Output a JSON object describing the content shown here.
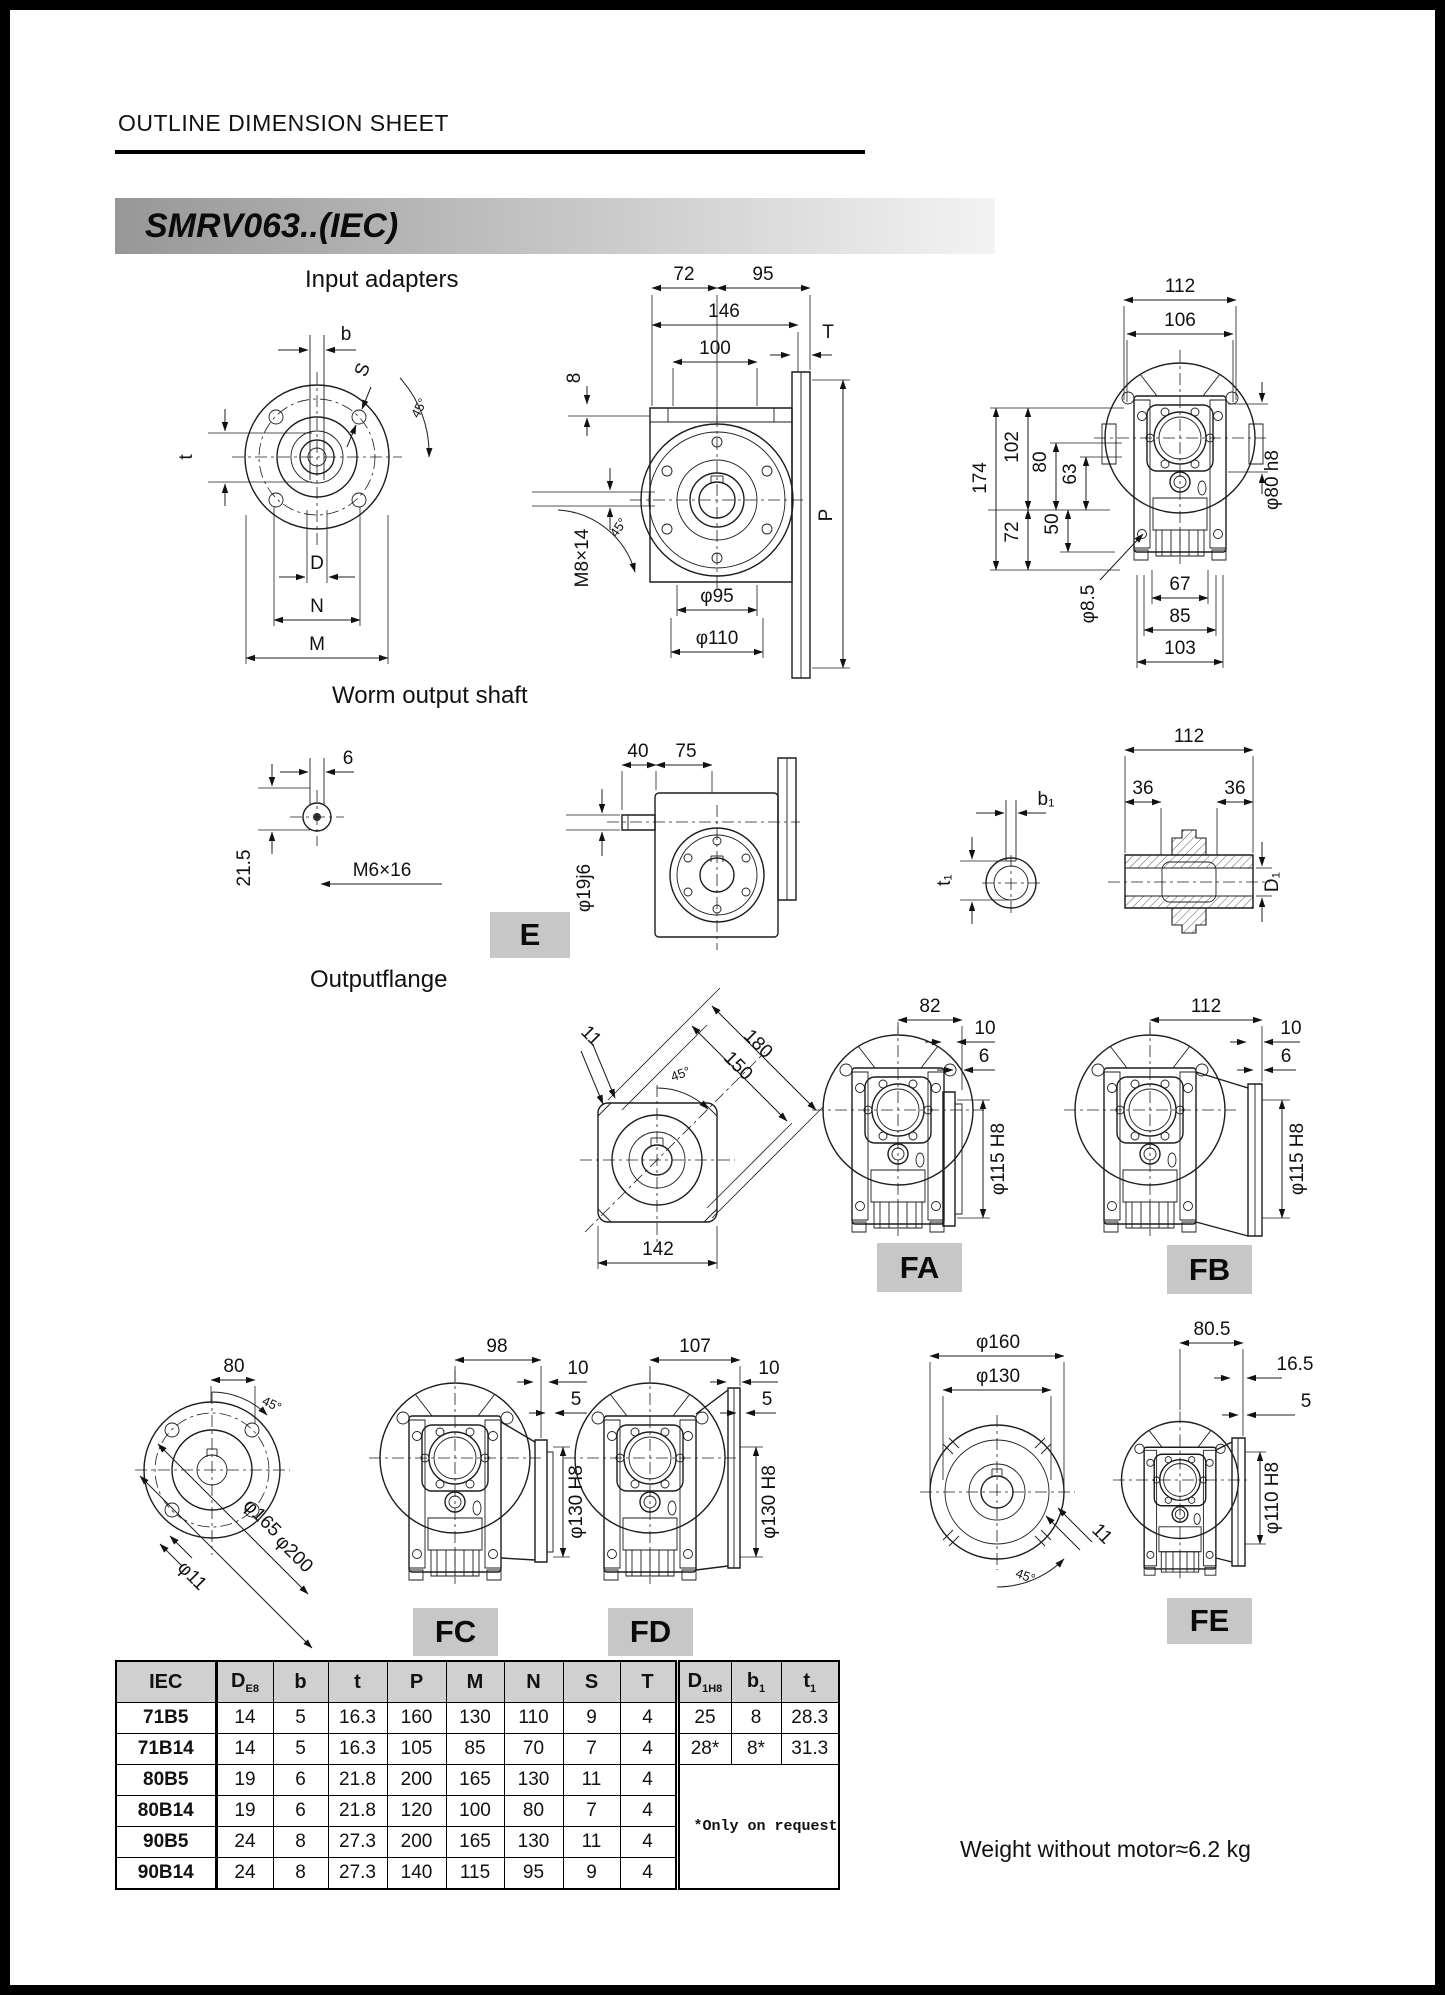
{
  "page": {
    "title": "OUTLINE DIMENSION SHEET",
    "model": "SMRV063..(IEC)",
    "weight_note": "Weight without motor≈6.2 kg"
  },
  "sections": {
    "input_adapters": "Input adapters",
    "worm_output_shaft": "Worm output shaft",
    "output_flange": "Outputflange"
  },
  "badges": {
    "e": "E",
    "fa": "FA",
    "fb": "FB",
    "fc": "FC",
    "fd": "FD",
    "fe": "FE"
  },
  "dims": {
    "input_front": {
      "b": "b",
      "s": "S",
      "a45": "45°",
      "t": "t",
      "d": "D",
      "n": "N",
      "m": "M"
    },
    "input_side": {
      "w72": "72",
      "w95": "95",
      "w146": "146",
      "w100": "100",
      "t": "T",
      "h8": "8",
      "p": "P",
      "m8x14": "M8×14",
      "a45": "45°",
      "dia95": "φ95",
      "dia110": "φ110"
    },
    "input_back": {
      "w112": "112",
      "w106": "106",
      "h174": "174",
      "h102": "102",
      "h80": "80",
      "h63": "63",
      "h72": "72",
      "h50": "50",
      "dia8_5": "φ8.5",
      "w67": "67",
      "w85": "85",
      "w103": "103",
      "dia80": "φ80 h8"
    },
    "shaft_end": {
      "w6": "6",
      "h21_5": "21.5",
      "m6x16": "M6×16"
    },
    "shaft_side": {
      "w40": "40",
      "w75": "75",
      "dia19": "φ19j6"
    },
    "key_section": {
      "b1": "b₁",
      "t1": "t₁"
    },
    "hollow_shaft": {
      "w112": "112",
      "w36a": "36",
      "w36b": "36",
      "d1": "D₁"
    },
    "square_flange": {
      "c11": "11",
      "d180": "180",
      "d150": "150",
      "a45": "45°",
      "w142": "142"
    },
    "fa": {
      "w82": "82",
      "t10": "10",
      "t6": "6",
      "dia": "φ115 H8"
    },
    "fb": {
      "w112": "112",
      "t10": "10",
      "t6": "6",
      "dia": "φ115 H8"
    },
    "round_flange": {
      "w80": "80",
      "a45": "45°",
      "dia11": "φ11",
      "dia165": "φ165",
      "dia200": "φ200"
    },
    "fc": {
      "w98": "98",
      "t10": "10",
      "t5": "5",
      "dia": "φ130 H8"
    },
    "fd": {
      "w107": "107",
      "t10": "10",
      "t5": "5",
      "dia": "φ130 H8"
    },
    "fe_flange": {
      "dia160": "φ160",
      "dia130": "φ130",
      "c11": "11",
      "a45": "45°"
    },
    "fe": {
      "w80_5": "80.5",
      "w16_5": "16.5",
      "t5": "5",
      "dia": "φ110 H8"
    }
  },
  "table": {
    "headers": [
      {
        "main": "IEC",
        "sub": ""
      },
      {
        "main": "D",
        "sub": "E8"
      },
      {
        "main": "b",
        "sub": ""
      },
      {
        "main": "t",
        "sub": ""
      },
      {
        "main": "P",
        "sub": ""
      },
      {
        "main": "M",
        "sub": ""
      },
      {
        "main": "N",
        "sub": ""
      },
      {
        "main": "S",
        "sub": ""
      },
      {
        "main": "T",
        "sub": ""
      },
      {
        "main": "D",
        "sub": "1H8"
      },
      {
        "main": "b",
        "sub": "1"
      },
      {
        "main": "t",
        "sub": "1"
      }
    ],
    "rows": [
      {
        "iec": "71B5",
        "vals": [
          "14",
          "5",
          "16.3",
          "160",
          "130",
          "110",
          "9",
          "4"
        ],
        "right": [
          "25",
          "8",
          "28.3"
        ]
      },
      {
        "iec": "71B14",
        "vals": [
          "14",
          "5",
          "16.3",
          "105",
          "85",
          "70",
          "7",
          "4"
        ],
        "right": [
          "28*",
          "8*",
          "31.3"
        ]
      },
      {
        "iec": "80B5",
        "vals": [
          "19",
          "6",
          "21.8",
          "200",
          "165",
          "130",
          "11",
          "4"
        ]
      },
      {
        "iec": "80B14",
        "vals": [
          "19",
          "6",
          "21.8",
          "120",
          "100",
          "80",
          "7",
          "4"
        ]
      },
      {
        "iec": "90B5",
        "vals": [
          "24",
          "8",
          "27.3",
          "200",
          "165",
          "130",
          "11",
          "4"
        ]
      },
      {
        "iec": "90B14",
        "vals": [
          "24",
          "8",
          "27.3",
          "140",
          "115",
          "95",
          "9",
          "4"
        ]
      }
    ],
    "note": "*Only on request"
  }
}
